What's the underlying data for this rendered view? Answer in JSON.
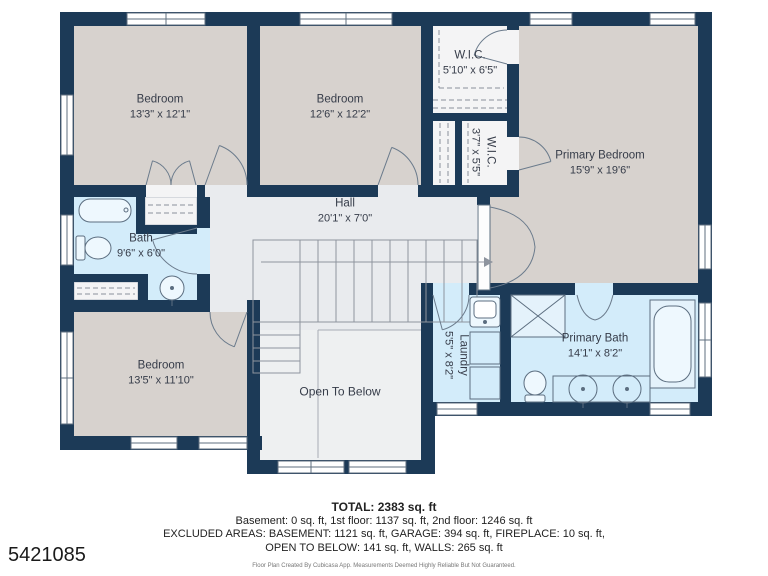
{
  "floor_plan": {
    "rooms": [
      {
        "id": "bedroom-1",
        "name": "Bedroom",
        "dims": "13'3\" x 12'1\""
      },
      {
        "id": "bedroom-2",
        "name": "Bedroom",
        "dims": "12'6\" x 12'2\""
      },
      {
        "id": "wic-1",
        "name": "W.I.C.",
        "dims": "5'10\" x 6'5\""
      },
      {
        "id": "wic-2",
        "name": "W.I.C.",
        "dims": "3'7\" x 5'5\""
      },
      {
        "id": "primary-bedroom",
        "name": "Primary Bedroom",
        "dims": "15'9\" x 19'6\""
      },
      {
        "id": "hall",
        "name": "Hall",
        "dims": "20'1\" x 7'0\""
      },
      {
        "id": "bath",
        "name": "Bath",
        "dims": "9'6\" x 6'0\""
      },
      {
        "id": "bedroom-3",
        "name": "Bedroom",
        "dims": "13'5\" x 11'10\""
      },
      {
        "id": "open-to-below",
        "name": "Open To Below",
        "dims": ""
      },
      {
        "id": "laundry",
        "name": "Laundry",
        "dims": "5'5\" x 8'2\""
      },
      {
        "id": "primary-bath",
        "name": "Primary Bath",
        "dims": "14'1\" x 8'2\""
      }
    ],
    "fixtures": [
      "bathtub",
      "toilet",
      "sink",
      "shower",
      "double-vanity",
      "washer",
      "dryer",
      "laundry-sink",
      "stairs"
    ],
    "colors": {
      "walls": "#1c3a57",
      "bedroom_fill": "#d7d2ce",
      "bath_fill": "#d3ecfa",
      "hall_fill": "#e9ebee",
      "closet_fill": "#f4f4f5",
      "background": "#ffffff"
    }
  },
  "footer": {
    "total": "TOTAL: 2383 sq. ft",
    "line1": "Basement: 0 sq. ft, 1st floor: 1137 sq. ft, 2nd floor: 1246 sq. ft",
    "line2": "EXCLUDED AREAS: BASEMENT: 1121 sq. ft, GARAGE: 394 sq. ft, FIREPLACE: 10 sq. ft,",
    "line3": "OPEN TO BELOW: 141 sq. ft, WALLS: 265 sq. ft",
    "disclaimer": "Floor Plan Created By Cubicasa App. Measurements Deemed Highly Reliable But Not Guaranteed."
  },
  "listing_id": "5421085"
}
